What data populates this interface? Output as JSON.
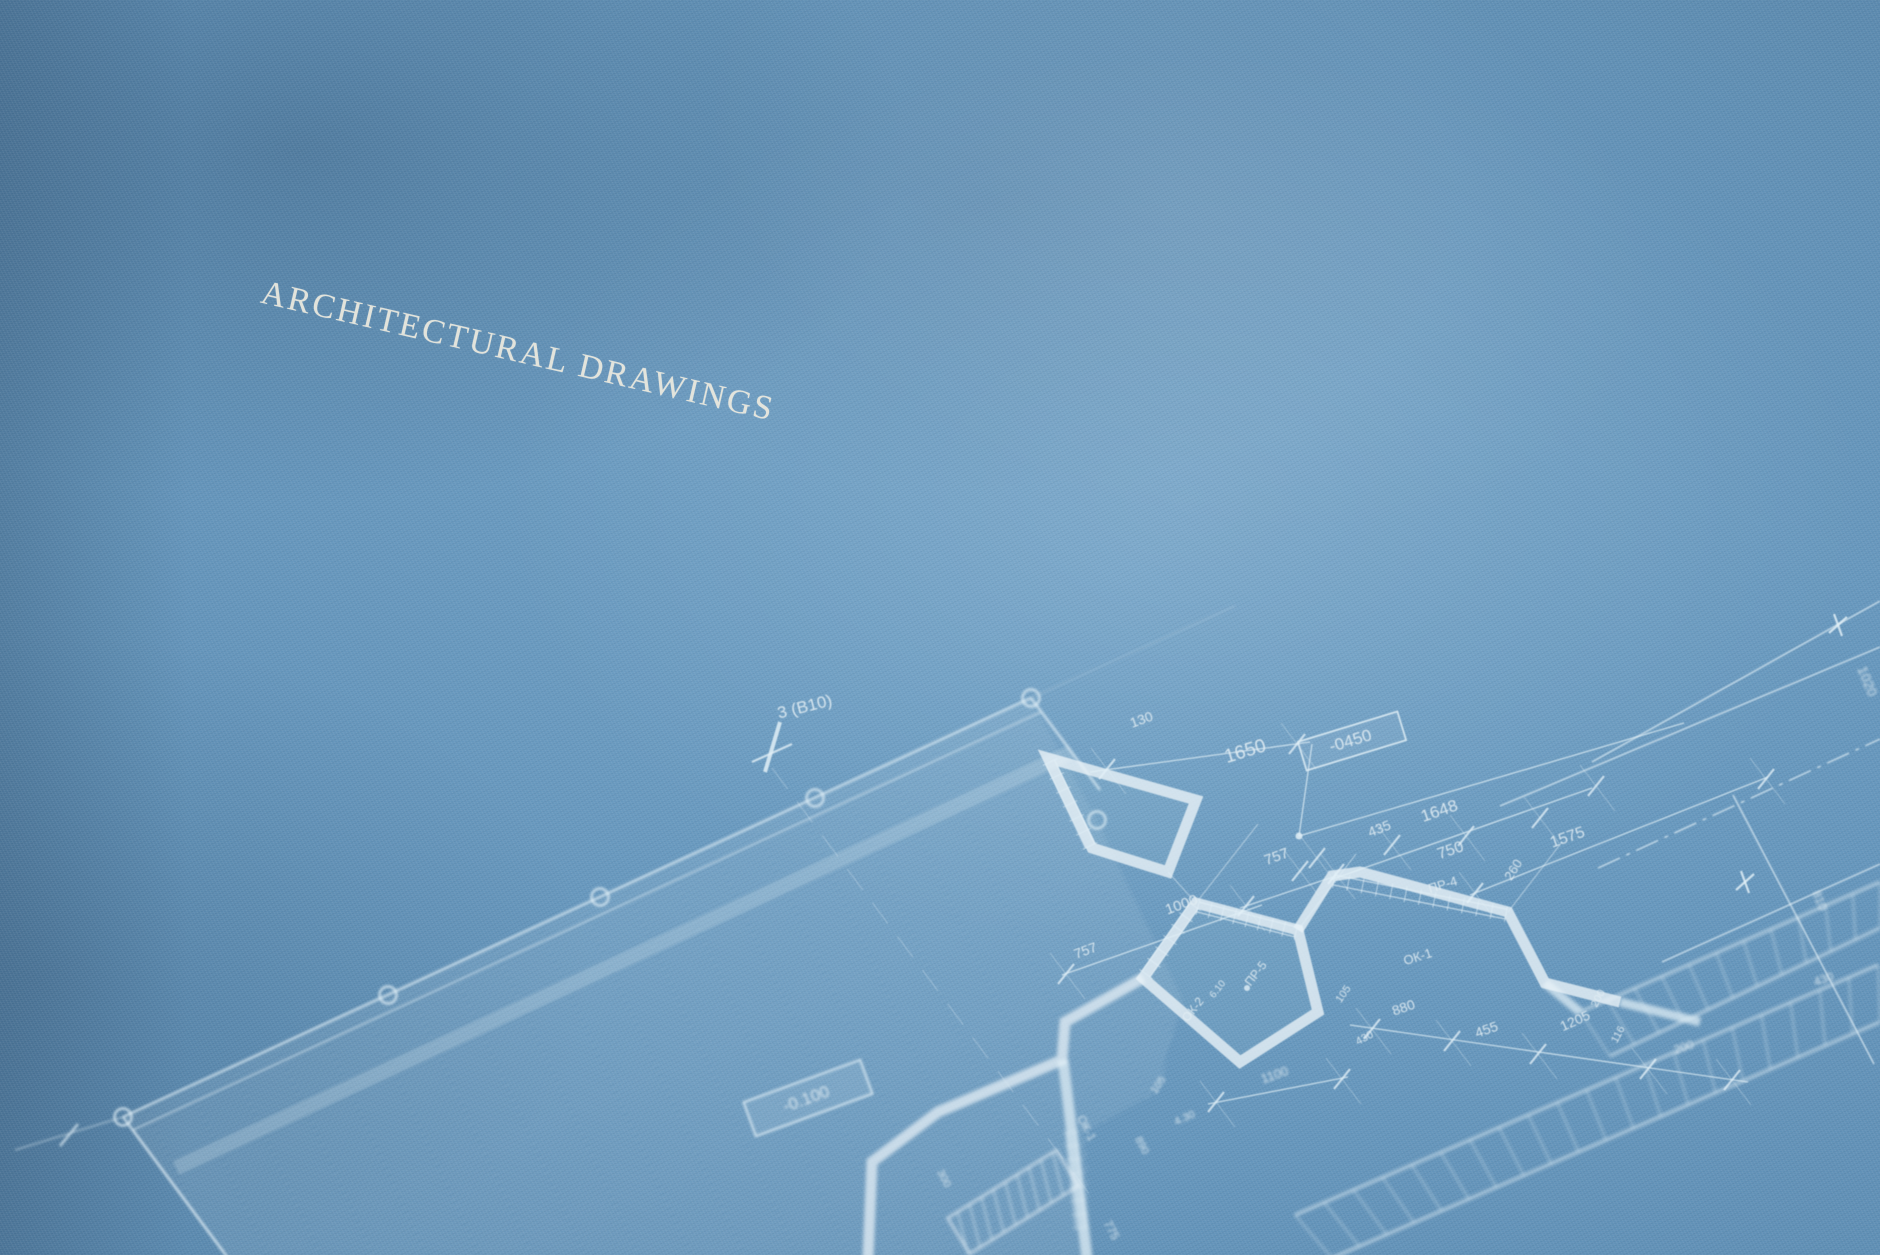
{
  "title": {
    "text": "ARCHITECTURAL DRAWINGS"
  },
  "colors": {
    "paper": "#6495bb",
    "paper_light": "#74a3c8",
    "paper_shadow": "#4f7ba1",
    "ink": "#e0ecf3",
    "title_ink": "#ecebe1"
  },
  "drawing": {
    "axis_grid_label": "3 (B10)",
    "elevation_marks": [
      "-0450",
      "-0.100"
    ],
    "window_marks": [
      "ОК-1",
      "ОК-2"
    ],
    "lintel_marks": [
      "ПР-4",
      "ПР-5"
    ],
    "labels": [
      {
        "text": "3 (B10)",
        "x": 806,
        "y": 712,
        "rot": -14,
        "fs": 17
      },
      {
        "text": "130",
        "x": 1143,
        "y": 724,
        "rot": -20,
        "fs": 14
      },
      {
        "text": "1650",
        "x": 1247,
        "y": 757,
        "rot": -17,
        "fs": 19
      },
      {
        "text": "-0450",
        "x": 1352,
        "y": 746,
        "rot": -17,
        "fs": 17
      },
      {
        "text": "1648",
        "x": 1441,
        "y": 816,
        "rot": -19,
        "fs": 17
      },
      {
        "text": "435",
        "x": 1381,
        "y": 833,
        "rot": -21,
        "fs": 14
      },
      {
        "text": "757",
        "x": 1278,
        "y": 861,
        "rot": -20,
        "fs": 15
      },
      {
        "text": "750",
        "x": 1452,
        "y": 855,
        "rot": -19,
        "fs": 16
      },
      {
        "text": "260",
        "x": 1517,
        "y": 872,
        "rot": -58,
        "fs": 13
      },
      {
        "text": "1575",
        "x": 1569,
        "y": 842,
        "rot": -19,
        "fs": 16
      },
      {
        "text": "ПР-4",
        "x": 1444,
        "y": 889,
        "rot": -17,
        "fs": 13
      },
      {
        "text": "1020",
        "x": 1863,
        "y": 683,
        "rot": 68,
        "fs": 14,
        "soft": true
      },
      {
        "text": "757",
        "x": 1087,
        "y": 955,
        "rot": -20,
        "fs": 14
      },
      {
        "text": "1000",
        "x": 1183,
        "y": 909,
        "rot": -20,
        "fs": 15
      },
      {
        "text": "ПР-5",
        "x": 1259,
        "y": 976,
        "rot": -52,
        "fs": 12
      },
      {
        "text": "6.10",
        "x": 1220,
        "y": 991,
        "rot": -52,
        "fs": 10
      },
      {
        "text": "ОК-2",
        "x": 1196,
        "y": 1012,
        "rot": -52,
        "fs": 12
      },
      {
        "text": "ОК-1",
        "x": 1419,
        "y": 961,
        "rot": -17,
        "fs": 13
      },
      {
        "text": "105",
        "x": 1346,
        "y": 996,
        "rot": -55,
        "fs": 11
      },
      {
        "text": "880",
        "x": 1405,
        "y": 1012,
        "rot": -19,
        "fs": 14
      },
      {
        "text": "430",
        "x": 1366,
        "y": 1041,
        "rot": -28,
        "fs": 11
      },
      {
        "text": "455",
        "x": 1488,
        "y": 1034,
        "rot": -19,
        "fs": 14
      },
      {
        "text": "1205",
        "x": 1577,
        "y": 1025,
        "rot": -24,
        "fs": 14
      },
      {
        "text": "200",
        "x": 1601,
        "y": 1000,
        "rot": -62,
        "fs": 11
      },
      {
        "text": "116",
        "x": 1621,
        "y": 1036,
        "rot": -62,
        "fs": 11
      },
      {
        "text": "200",
        "x": 1685,
        "y": 1051,
        "rot": -19,
        "fs": 12,
        "soft": true
      },
      {
        "text": "1100",
        "x": 1276,
        "y": 1079,
        "rot": -19,
        "fs": 13,
        "soft": true
      },
      {
        "text": "105",
        "x": 1161,
        "y": 1087,
        "rot": -55,
        "fs": 11,
        "soft": true
      },
      {
        "text": "4.30",
        "x": 1186,
        "y": 1121,
        "rot": -24,
        "fs": 11,
        "soft": true
      },
      {
        "text": "ОК-1",
        "x": 1083,
        "y": 1130,
        "rot": 62,
        "fs": 12,
        "soft": true
      },
      {
        "text": "890",
        "x": 1139,
        "y": 1147,
        "rot": 62,
        "fs": 11,
        "soft": true
      },
      {
        "text": "775",
        "x": 1108,
        "y": 1232,
        "rot": 62,
        "fs": 12,
        "soft": true
      },
      {
        "text": "300",
        "x": 941,
        "y": 1180,
        "rot": 62,
        "fs": 11,
        "soft": true
      },
      {
        "text": "810",
        "x": 1816,
        "y": 902,
        "rot": 68,
        "fs": 12,
        "soft": true
      },
      {
        "text": "430",
        "x": 1825,
        "y": 983,
        "rot": -19,
        "fs": 12,
        "soft": true
      },
      {
        "text": "-0.100",
        "x": 808,
        "y": 1104,
        "rot": -20,
        "fs": 17,
        "soft": true
      }
    ]
  }
}
